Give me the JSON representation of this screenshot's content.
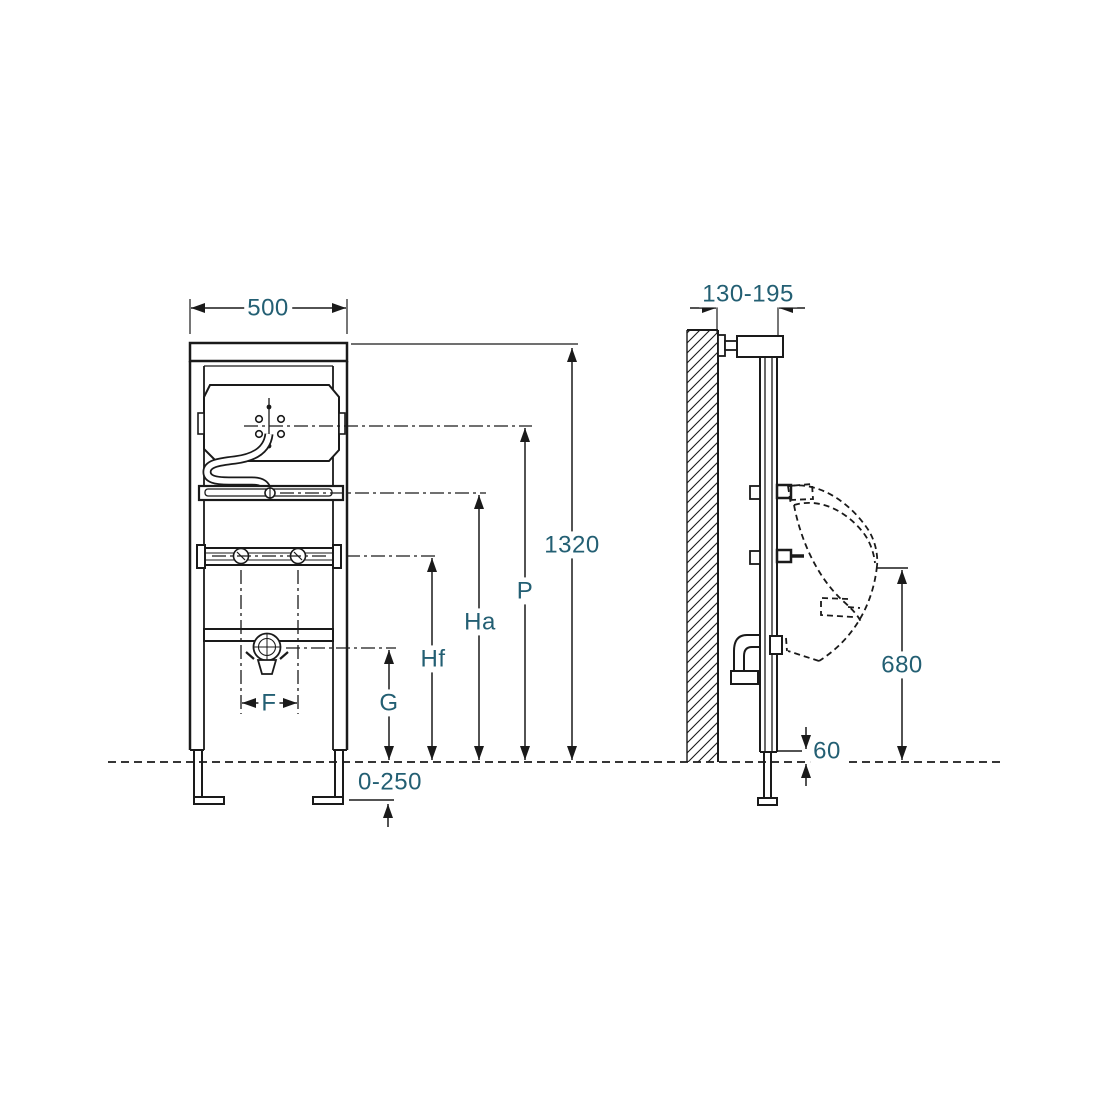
{
  "drawing": {
    "line_color": "#1a1a1a",
    "dimension_text_color": "#235f73",
    "front_view": {
      "dimensions": {
        "width": "500",
        "total_height": "1320",
        "p": "P",
        "ha": "Ha",
        "hf": "Hf",
        "g": "G",
        "f": "F",
        "foot_adjust_range": "0-250"
      }
    },
    "side_view": {
      "dimensions": {
        "depth_range": "130-195",
        "rim_height": "680",
        "bottom_clearance": "60"
      }
    }
  }
}
